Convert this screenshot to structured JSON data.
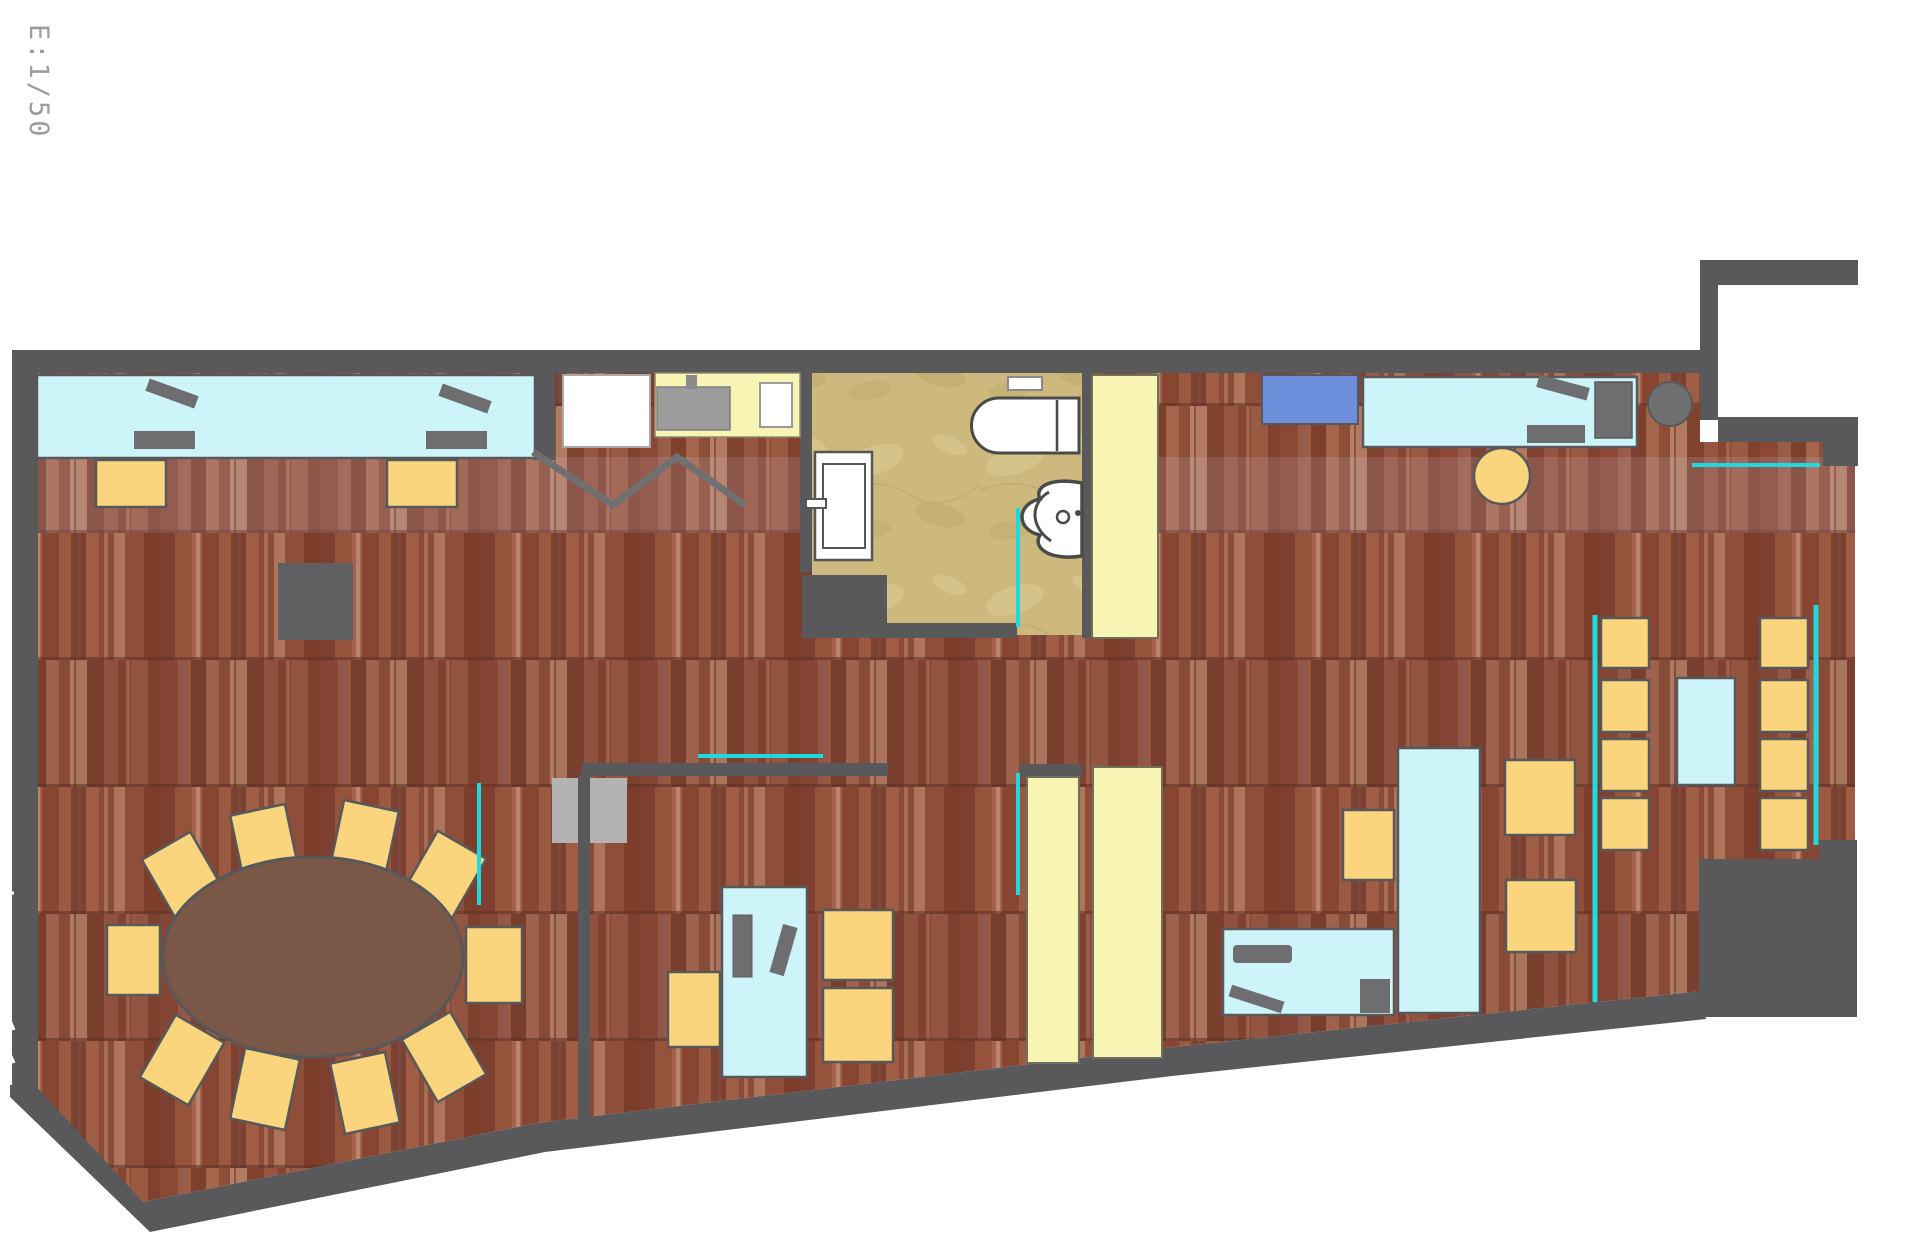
{
  "scale_label": "E:1/50",
  "colors": {
    "wall": "#59595b",
    "wall2": "#606062",
    "desk": "#cdf5f9",
    "chair": "#fbd57d",
    "panel": "#f8f5b4",
    "glass": "#1fd9e0",
    "blue": "#6d8edb",
    "blue2": "#7191da",
    "equip": "#6e6e70",
    "leaf": "#b3b3b3",
    "oval": "#7b5747",
    "white": "#ffffff",
    "sinkg": "#9c9c9c",
    "outline": "#58585a",
    "dark": "#4a4a4a",
    "label": "#9c9c9c"
  },
  "elements": [
    {
      "n": "wood-floor",
      "t": "poly",
      "p": "38,373 1700,373 1700,442 1855,442 1855,1017 1702,1017 1702,991 1165,1048 537,1123 143,1202 35,1090",
      "f": "url(#woodPat)"
    },
    {
      "n": "floor-band-light",
      "t": "rect",
      "x": 38,
      "y": 457,
      "w": 1817,
      "h": 76,
      "f": "#d9cce6",
      "o": 0.15,
      "clip": 1
    },
    {
      "n": "floor-band-dark-1",
      "t": "rect",
      "x": 38,
      "y": 660,
      "w": 1817,
      "h": 127,
      "f": "#2e1f3a",
      "o": 0.06,
      "clip": 1
    },
    {
      "n": "floor-band-dark-2",
      "t": "rect",
      "x": 38,
      "y": 913,
      "w": 1817,
      "h": 127,
      "f": "#2e1f3a",
      "o": 0.06,
      "clip": 1
    },
    {
      "n": "bathroom-floor",
      "t": "poly",
      "p": "812,373 1082,373 1082,635 1017,635 1017,623 887,623 887,575 812,575",
      "f": "url(#tanPat)"
    },
    {
      "n": "entry-alcove",
      "t": "rect",
      "x": 1718,
      "y": 285,
      "w": 140,
      "h": 132,
      "f": "$white"
    },
    {
      "n": "gray-door-leaf",
      "t": "rect",
      "x": 552,
      "y": 778,
      "w": 75,
      "h": 65,
      "f": "$leaf"
    },
    {
      "n": "wall-top",
      "t": "rect",
      "x": 12,
      "y": 350,
      "w": 1694,
      "h": 23,
      "f": "$wall"
    },
    {
      "n": "wall-left",
      "t": "rect",
      "x": 12,
      "y": 350,
      "w": 26,
      "h": 740,
      "f": "$wall"
    },
    {
      "n": "wall-nook-top",
      "t": "rect",
      "x": 1700,
      "y": 260,
      "w": 158,
      "h": 25,
      "f": "$wall"
    },
    {
      "n": "wall-nook-arm",
      "t": "rect",
      "x": 1700,
      "y": 260,
      "w": 18,
      "h": 160,
      "f": "$wall"
    },
    {
      "n": "wall-nook-bottom",
      "t": "rect",
      "x": 1718,
      "y": 417,
      "w": 140,
      "h": 25,
      "f": "$wall"
    },
    {
      "n": "wall-nook-right",
      "t": "rect",
      "x": 1823,
      "y": 442,
      "w": 35,
      "h": 24,
      "f": "$wall"
    },
    {
      "n": "wall-bottom",
      "t": "poly",
      "p": "35,1085 143,1202 537,1123 1165,1048 1702,991 1706,1019 1172,1076 545,1152 150,1232 10,1097 10,1085",
      "f": "$wall"
    },
    {
      "n": "wall-bath-left",
      "t": "rect",
      "x": 800,
      "y": 350,
      "w": 12,
      "h": 222,
      "f": "$wall"
    },
    {
      "n": "wall-bath-right",
      "t": "rect",
      "x": 1082,
      "y": 373,
      "w": 10,
      "h": 265,
      "f": "$wall"
    },
    {
      "n": "wall-bath-corner",
      "t": "rect",
      "x": 802,
      "y": 575,
      "w": 85,
      "h": 63,
      "f": "$wall"
    },
    {
      "n": "wall-bath-bottom",
      "t": "rect",
      "x": 887,
      "y": 623,
      "w": 130,
      "h": 15,
      "f": "$wall"
    },
    {
      "n": "wall-kitchen",
      "t": "rect",
      "x": 533,
      "y": 373,
      "w": 22,
      "h": 87,
      "f": "$wall"
    },
    {
      "n": "wall-divider-h",
      "t": "rect",
      "x": 582,
      "y": 763,
      "w": 306,
      "h": 13,
      "f": "$wall"
    },
    {
      "n": "wall-divider-v",
      "t": "rect",
      "x": 578,
      "y": 775,
      "w": 12,
      "h": 348,
      "f": "$wall"
    },
    {
      "n": "stair-block",
      "t": "poly",
      "p": "1699,859 1819,859 1819,840 1857,840 1857,1017 1699,1017",
      "f": "$wall"
    },
    {
      "n": "cabinet-gray-box",
      "t": "rect",
      "x": 278,
      "y": 563,
      "w": 75,
      "h": 77,
      "f": "$wall2"
    },
    {
      "n": "counter-top-left",
      "t": "rect",
      "x": 37,
      "y": 375,
      "w": 498,
      "h": 83,
      "f": "$desk",
      "s": "$outline",
      "sw": 2.5
    },
    {
      "n": "desk-top-right",
      "t": "rect",
      "x": 1363,
      "y": 377,
      "w": 274,
      "h": 70,
      "f": "$desk",
      "s": "$outline",
      "sw": 2.5
    },
    {
      "n": "desk-vertical-right",
      "t": "rect",
      "x": 1398,
      "y": 748,
      "w": 82,
      "h": 265,
      "f": "$desk",
      "s": "$outline",
      "sw": 2.5
    },
    {
      "n": "desk-horizontal-bottom",
      "t": "rect",
      "x": 1223,
      "y": 929,
      "w": 171,
      "h": 86,
      "f": "$desk",
      "s": "$outline",
      "sw": 2.5
    },
    {
      "n": "desk-small-middle",
      "t": "rect",
      "x": 722,
      "y": 887,
      "w": 85,
      "h": 190,
      "f": "$desk",
      "s": "$outline",
      "sw": 2.5
    },
    {
      "n": "table-mid-right",
      "t": "rect",
      "x": 1677,
      "y": 678,
      "w": 58,
      "h": 107,
      "f": "$desk",
      "s": "$outline",
      "sw": 2.5
    },
    {
      "n": "fridge",
      "t": "rect",
      "x": 563,
      "y": 375,
      "w": 87,
      "h": 72,
      "f": "$white",
      "s": "#a8a8a8",
      "sw": 2
    },
    {
      "n": "kitchen-counter",
      "t": "rect",
      "x": 655,
      "y": 373,
      "w": 145,
      "h": 64,
      "f": "$panel",
      "s": "#8a8a6a",
      "sw": 1.5
    },
    {
      "n": "kitchen-sink-unit",
      "t": "rect",
      "x": 657,
      "y": 387,
      "w": 73,
      "h": 43,
      "f": "$sinkg",
      "s": "#7e7e7e",
      "sw": 1.5
    },
    {
      "n": "kitchen-tap",
      "t": "rect",
      "x": 686,
      "y": 375,
      "w": 11,
      "h": 14,
      "f": "#8a8a8a"
    },
    {
      "n": "kitchen-basin",
      "t": "rect",
      "x": 760,
      "y": 383,
      "w": 32,
      "h": 44,
      "f": "$white",
      "s": "#9a9a9a",
      "sw": 2
    },
    {
      "n": "door-panel-top",
      "t": "rect",
      "x": 1092,
      "y": 375,
      "w": 66,
      "h": 263,
      "f": "$panel",
      "s": "#6f6f5a",
      "sw": 2
    },
    {
      "n": "door-panel-header",
      "t": "rect",
      "x": 1020,
      "y": 764,
      "w": 62,
      "h": 13,
      "f": "$wall"
    },
    {
      "n": "door-panel-bottom-left",
      "t": "rect",
      "x": 1027,
      "y": 777,
      "w": 52,
      "h": 286,
      "f": "$panel",
      "s": "#6f6f5a",
      "sw": 2
    },
    {
      "n": "door-panel-bottom-right",
      "t": "rect",
      "x": 1093,
      "y": 767,
      "w": 69,
      "h": 291,
      "f": "$panel",
      "s": "#6f6f5a",
      "sw": 2
    },
    {
      "n": "blue-cabinet",
      "t": "rect",
      "x": 1262,
      "y": 375,
      "w": 96,
      "h": 49,
      "f": "$blue",
      "s": "$outline",
      "sw": 2
    },
    {
      "n": "monitor-1",
      "t": "rect",
      "x": 146,
      "y": 387,
      "w": 52,
      "h": 13,
      "f": "$equip",
      "r": 20
    },
    {
      "n": "keyboard-1",
      "t": "rect",
      "x": 134,
      "y": 431,
      "w": 61,
      "h": 18,
      "f": "$equip"
    },
    {
      "n": "monitor-2",
      "t": "rect",
      "x": 439,
      "y": 392,
      "w": 52,
      "h": 13,
      "f": "$equip",
      "r": 20
    },
    {
      "n": "keyboard-2",
      "t": "rect",
      "x": 426,
      "y": 431,
      "w": 61,
      "h": 18,
      "f": "$equip"
    },
    {
      "n": "monitor-3",
      "t": "rect",
      "x": 1537,
      "y": 381,
      "w": 52,
      "h": 13,
      "f": "$equip",
      "r": 15
    },
    {
      "n": "keyboard-3",
      "t": "rect",
      "x": 1527,
      "y": 425,
      "w": 58,
      "h": 18,
      "f": "$equip"
    },
    {
      "n": "printer",
      "t": "rect",
      "x": 1595,
      "y": 382,
      "w": 37,
      "h": 56,
      "f": "$equip",
      "s": "$outline",
      "sw": 1.5
    },
    {
      "n": "round-side-table",
      "t": "circle",
      "cx": 1670,
      "cy": 404,
      "r": 22,
      "f": "#6f6f71",
      "s": "$outline",
      "sw": 2
    },
    {
      "n": "cpu-small-desk",
      "t": "rect",
      "x": 733,
      "y": 915,
      "w": 19,
      "h": 62,
      "f": "$equip",
      "s": "#5a5a5a",
      "sw": 1
    },
    {
      "n": "monitor-small-desk",
      "t": "rect",
      "x": 776,
      "y": 925,
      "w": 15,
      "h": 50,
      "f": "$equip",
      "r": 16
    },
    {
      "n": "shelf-bottom-desk",
      "t": "rect",
      "x": 1233,
      "y": 945,
      "w": 59,
      "h": 18,
      "rx": 4,
      "f": "$equip"
    },
    {
      "n": "monitor-bottom-desk",
      "t": "rect",
      "x": 1229,
      "y": 993,
      "w": 55,
      "h": 12,
      "f": "$equip",
      "r": 18
    },
    {
      "n": "cpu-bottom-desk",
      "t": "rect",
      "x": 1360,
      "y": 979,
      "w": 30,
      "h": 34,
      "f": "$equip"
    },
    {
      "n": "chair",
      "t": "rect",
      "x": 96,
      "y": 460,
      "w": 70,
      "h": 47,
      "f": "$chair",
      "s": "$outline",
      "sw": 2.5
    },
    {
      "n": "chair",
      "t": "rect",
      "x": 387,
      "y": 460,
      "w": 70,
      "h": 47,
      "f": "$chair",
      "s": "$outline",
      "sw": 2.5
    },
    {
      "n": "chair-round",
      "t": "circle",
      "cx": 1502,
      "cy": 476,
      "r": 28,
      "f": "$chair",
      "s": "$outline",
      "sw": 2.5
    },
    {
      "n": "chair",
      "t": "rect",
      "x": 1601,
      "y": 618,
      "w": 48,
      "h": 50,
      "f": "$chair",
      "s": "$outline",
      "sw": 2.5
    },
    {
      "n": "chair",
      "t": "rect",
      "x": 1601,
      "y": 680,
      "w": 48,
      "h": 52,
      "f": "$chair",
      "s": "$outline",
      "sw": 2.5
    },
    {
      "n": "chair",
      "t": "rect",
      "x": 1601,
      "y": 739,
      "w": 48,
      "h": 52,
      "f": "$chair",
      "s": "$outline",
      "sw": 2.5
    },
    {
      "n": "chair",
      "t": "rect",
      "x": 1601,
      "y": 798,
      "w": 48,
      "h": 52,
      "f": "$chair",
      "s": "$outline",
      "sw": 2.5
    },
    {
      "n": "chair",
      "t": "rect",
      "x": 1760,
      "y": 618,
      "w": 48,
      "h": 50,
      "f": "$chair",
      "s": "$outline",
      "sw": 2.5
    },
    {
      "n": "chair",
      "t": "rect",
      "x": 1760,
      "y": 680,
      "w": 48,
      "h": 52,
      "f": "$chair",
      "s": "$outline",
      "sw": 2.5
    },
    {
      "n": "chair",
      "t": "rect",
      "x": 1760,
      "y": 739,
      "w": 48,
      "h": 52,
      "f": "$chair",
      "s": "$outline",
      "sw": 2.5
    },
    {
      "n": "chair",
      "t": "rect",
      "x": 1760,
      "y": 798,
      "w": 48,
      "h": 52,
      "f": "$chair",
      "s": "$outline",
      "sw": 2.5
    },
    {
      "n": "chair",
      "t": "rect",
      "x": 1505,
      "y": 760,
      "w": 70,
      "h": 75,
      "f": "$chair",
      "s": "$outline",
      "sw": 2.5
    },
    {
      "n": "chair",
      "t": "rect",
      "x": 1506,
      "y": 880,
      "w": 70,
      "h": 72,
      "f": "$chair",
      "s": "$outline",
      "sw": 2.5
    },
    {
      "n": "chair",
      "t": "rect",
      "x": 1343,
      "y": 810,
      "w": 51,
      "h": 70,
      "f": "$chair",
      "s": "$outline",
      "sw": 2.5
    },
    {
      "n": "chair",
      "t": "rect",
      "x": 668,
      "y": 972,
      "w": 52,
      "h": 75,
      "f": "$chair",
      "s": "$outline",
      "sw": 2.5
    },
    {
      "n": "chair",
      "t": "rect",
      "x": 823,
      "y": 910,
      "w": 70,
      "h": 70,
      "f": "$chair",
      "s": "$outline",
      "sw": 2.5
    },
    {
      "n": "chair",
      "t": "rect",
      "x": 823,
      "y": 988,
      "w": 70,
      "h": 74,
      "f": "$chair",
      "s": "$outline",
      "sw": 2.5
    },
    {
      "n": "conference-chair",
      "t": "rect",
      "x": 107,
      "y": 925,
      "w": 53,
      "h": 70,
      "f": "$chair",
      "s": "$outline",
      "sw": 2.5
    },
    {
      "n": "conference-chair",
      "t": "rect",
      "x": 466,
      "y": 927,
      "w": 56,
      "h": 76,
      "f": "$chair",
      "s": "$outline",
      "sw": 2.5
    },
    {
      "n": "conference-chair",
      "t": "rect",
      "x": 156,
      "y": 841,
      "w": 56,
      "h": 72,
      "f": "$chair",
      "s": "$outline",
      "sw": 2.5,
      "r": -30
    },
    {
      "n": "conference-chair",
      "t": "rect",
      "x": 237,
      "y": 809,
      "w": 56,
      "h": 72,
      "f": "$chair",
      "s": "$outline",
      "sw": 2.5,
      "r": -12
    },
    {
      "n": "conference-chair",
      "t": "rect",
      "x": 336,
      "y": 805,
      "w": 56,
      "h": 72,
      "f": "$chair",
      "s": "$outline",
      "sw": 2.5,
      "r": 12
    },
    {
      "n": "conference-chair",
      "t": "rect",
      "x": 416,
      "y": 840,
      "w": 56,
      "h": 72,
      "f": "$chair",
      "s": "$outline",
      "sw": 2.5,
      "r": 30
    },
    {
      "n": "conference-chair",
      "t": "rect",
      "x": 154,
      "y": 1024,
      "w": 56,
      "h": 72,
      "f": "$chair",
      "s": "$outline",
      "sw": 2.5,
      "r": 30
    },
    {
      "n": "conference-chair",
      "t": "rect",
      "x": 237,
      "y": 1053,
      "w": 56,
      "h": 72,
      "f": "$chair",
      "s": "$outline",
      "sw": 2.5,
      "r": 12
    },
    {
      "n": "conference-chair",
      "t": "rect",
      "x": 337,
      "y": 1057,
      "w": 56,
      "h": 72,
      "f": "$chair",
      "s": "$outline",
      "sw": 2.5,
      "r": -12
    },
    {
      "n": "conference-chair",
      "t": "rect",
      "x": 416,
      "y": 1021,
      "w": 56,
      "h": 72,
      "f": "$chair",
      "s": "$outline",
      "sw": 2.5,
      "r": -30
    },
    {
      "n": "conference-table",
      "t": "ellipse",
      "cx": 313,
      "cy": 957,
      "rx": 150,
      "ry": 100,
      "f": "$oval",
      "s": "$outline",
      "sw": 3
    },
    {
      "n": "toilet",
      "t": "path",
      "d": "M1079,398 L999,398 A27.5,27.5 0 0 0 999,453 L1079,453 Z",
      "f": "$white",
      "s": "$dark",
      "sw": 3
    },
    {
      "n": "toilet-tank-line",
      "t": "line",
      "x1": 1057,
      "y1": 400,
      "x2": 1057,
      "y2": 451,
      "s": "$dark",
      "sw": 2.5
    },
    {
      "n": "toilet-flush-button",
      "t": "rect",
      "x": 1008,
      "y": 377,
      "w": 34,
      "h": 13,
      "f": "$white",
      "s": "#8a8a8a",
      "sw": 2
    },
    {
      "n": "sink",
      "t": "path",
      "d": "M1082,483 C1050,477 1034,487 1040,499 C1016,504 1016,530 1040,535 C1032,548 1050,561 1082,556 Z",
      "f": "$white",
      "s": "$dark",
      "sw": 3.5
    },
    {
      "n": "sink-bowl-arc",
      "t": "path",
      "d": "M1049,492 C1030,503 1030,527 1051,541",
      "f": "none",
      "s": "$dark",
      "sw": 3
    },
    {
      "n": "sink-drain",
      "t": "circle",
      "cx": 1063,
      "cy": 517,
      "r": 6,
      "f": "$white",
      "s": "$dark",
      "sw": 2.5
    },
    {
      "n": "sink-tap-dot",
      "t": "circle",
      "cx": 1078,
      "cy": 513,
      "r": 3,
      "f": "$dark"
    },
    {
      "n": "bathroom-door",
      "t": "rect",
      "x": 815,
      "y": 452,
      "w": 57,
      "h": 108,
      "f": "$white",
      "s": "#565656",
      "sw": 2.5
    },
    {
      "n": "bathroom-door-panel",
      "t": "rect",
      "x": 823,
      "y": 464,
      "w": 42,
      "h": 84,
      "f": "$white",
      "s": "#565656",
      "sw": 2
    },
    {
      "n": "bathroom-door-handle",
      "t": "rect",
      "x": 806,
      "y": 499,
      "w": 20,
      "h": 9,
      "f": "$white",
      "s": "#565656",
      "sw": 2
    },
    {
      "n": "wardrobe-zigzag",
      "t": "polyline",
      "p": "533,452 613,505 677,457 745,505",
      "f": "none",
      "s": "#707070",
      "sw": 7
    },
    {
      "n": "glass-partition",
      "t": "line",
      "x1": 698,
      "y1": 756,
      "x2": 823,
      "y2": 756,
      "s": "$glass",
      "sw": 4
    },
    {
      "n": "glass-partition",
      "t": "line",
      "x1": 479,
      "y1": 783,
      "x2": 479,
      "y2": 905,
      "s": "$glass",
      "sw": 4
    },
    {
      "n": "glass-partition",
      "t": "line",
      "x1": 1018,
      "y1": 508,
      "x2": 1018,
      "y2": 627,
      "s": "$glass",
      "sw": 4
    },
    {
      "n": "glass-partition",
      "t": "line",
      "x1": 1018,
      "y1": 773,
      "x2": 1018,
      "y2": 895,
      "s": "$glass",
      "sw": 4
    },
    {
      "n": "glass-partition",
      "t": "line",
      "x1": 1595,
      "y1": 615,
      "x2": 1595,
      "y2": 1002,
      "s": "$glass",
      "sw": 5
    },
    {
      "n": "glass-partition",
      "t": "line",
      "x1": 1816,
      "y1": 605,
      "x2": 1816,
      "y2": 845,
      "s": "$glass",
      "sw": 5
    },
    {
      "n": "glass-partition",
      "t": "line",
      "x1": 1692,
      "y1": 465,
      "x2": 1820,
      "y2": 465,
      "s": "$glass",
      "sw": 4
    },
    {
      "n": "dimension-tick",
      "t": "line",
      "x1": 0,
      "y1": 565,
      "x2": 12,
      "y2": 565,
      "s": "#ffffff",
      "sw": 3
    },
    {
      "n": "dimension-tick",
      "t": "line",
      "x1": 0,
      "y1": 603,
      "x2": 12,
      "y2": 603,
      "s": "#ffffff",
      "sw": 3
    },
    {
      "n": "dimension-tick",
      "t": "line",
      "x1": 0,
      "y1": 893,
      "x2": 14,
      "y2": 893,
      "s": "#ffffff",
      "sw": 3
    },
    {
      "n": "dimension-tick",
      "t": "line",
      "x1": 0,
      "y1": 997,
      "x2": 14,
      "y2": 1030,
      "s": "#ffffff",
      "sw": 3
    },
    {
      "n": "dimension-tick",
      "t": "line",
      "x1": 0,
      "y1": 1032,
      "x2": 14,
      "y2": 1063,
      "s": "#ffffff",
      "sw": 3
    },
    {
      "n": "scale-label",
      "t": "text",
      "x": 30,
      "y": 24,
      "r": 90,
      "fs": 27,
      "ls": 3,
      "f": "$label",
      "k": "scale_label"
    }
  ]
}
